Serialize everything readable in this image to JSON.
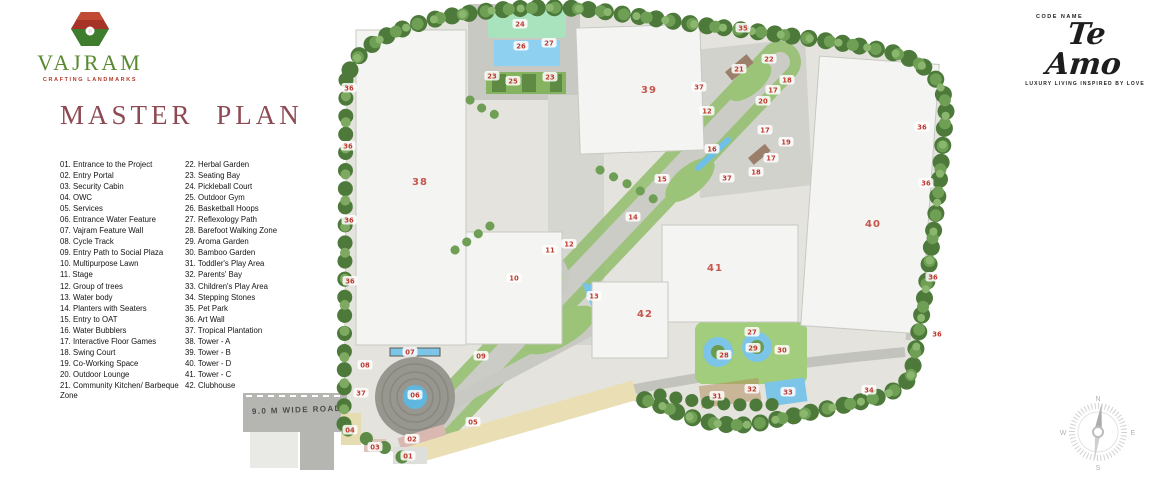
{
  "brand": {
    "name": "VAJRAM",
    "tagline": "CRAFTING LANDMARKS"
  },
  "project": {
    "pre": "CODE NAME",
    "name": "Te Amo",
    "tagline": "LUXURY LIVING INSPIRED BY LOVE"
  },
  "title": "MASTER PLAN",
  "legend": {
    "col1": [
      {
        "num": "01",
        "label": "Entrance to the Project"
      },
      {
        "num": "02",
        "label": "Entry Portal"
      },
      {
        "num": "03",
        "label": "Security Cabin"
      },
      {
        "num": "04",
        "label": "OWC"
      },
      {
        "num": "05",
        "label": "Services"
      },
      {
        "num": "06",
        "label": "Entrance Water Feature"
      },
      {
        "num": "07",
        "label": "Vajram Feature Wall"
      },
      {
        "num": "08",
        "label": "Cycle Track"
      },
      {
        "num": "09",
        "label": "Entry Path to Social Plaza"
      },
      {
        "num": "10",
        "label": "Multipurpose Lawn"
      },
      {
        "num": "11",
        "label": "Stage"
      },
      {
        "num": "12",
        "label": "Group of trees"
      },
      {
        "num": "13",
        "label": "Water body"
      },
      {
        "num": "14",
        "label": "Planters with Seaters"
      },
      {
        "num": "15",
        "label": "Entry to OAT"
      },
      {
        "num": "16",
        "label": "Water Bubblers"
      },
      {
        "num": "17",
        "label": "Interactive Floor Games"
      },
      {
        "num": "18",
        "label": "Swing Court"
      },
      {
        "num": "19",
        "label": "Co-Working Space"
      },
      {
        "num": "20",
        "label": "Outdoor Lounge"
      },
      {
        "num": "21",
        "label": "Community Kitchen/ Barbeque Zone"
      }
    ],
    "col2": [
      {
        "num": "22",
        "label": "Herbal Garden"
      },
      {
        "num": "23",
        "label": "Seating Bay"
      },
      {
        "num": "24",
        "label": "Pickleball Court"
      },
      {
        "num": "25",
        "label": "Outdoor Gym"
      },
      {
        "num": "26",
        "label": "Basketball Hoops"
      },
      {
        "num": "27",
        "label": "Reflexology Path"
      },
      {
        "num": "28",
        "label": "Barefoot Walking Zone"
      },
      {
        "num": "29",
        "label": "Aroma Garden"
      },
      {
        "num": "30",
        "label": "Bamboo Garden"
      },
      {
        "num": "31",
        "label": "Toddler's Play Area"
      },
      {
        "num": "32",
        "label": "Parents' Bay"
      },
      {
        "num": "33",
        "label": "Children's Play Area"
      },
      {
        "num": "34",
        "label": "Stepping Stones"
      },
      {
        "num": "35",
        "label": "Pet Park"
      },
      {
        "num": "36",
        "label": "Art Wall"
      },
      {
        "num": "37",
        "label": "Tropical Plantation"
      },
      {
        "num": "38",
        "label": "Tower - A"
      },
      {
        "num": "39",
        "label": "Tower - B"
      },
      {
        "num": "40",
        "label": "Tower - D"
      },
      {
        "num": "41",
        "label": "Tower - C"
      },
      {
        "num": "42",
        "label": "Clubhouse"
      }
    ]
  },
  "plan": {
    "road_label": "9.0 M WIDE ROAD",
    "compass": {
      "n": "N",
      "e": "E",
      "s": "S",
      "w": "W"
    },
    "markers": [
      [
        "01",
        408,
        456
      ],
      [
        "02",
        412,
        439
      ],
      [
        "03",
        375,
        447
      ],
      [
        "04",
        350,
        430
      ],
      [
        "05",
        473,
        422
      ],
      [
        "06",
        415,
        395
      ],
      [
        "07",
        410,
        352
      ],
      [
        "08",
        365,
        365
      ],
      [
        "09",
        481,
        356
      ],
      [
        "10",
        514,
        278
      ],
      [
        "11",
        550,
        250
      ],
      [
        "12",
        569,
        244
      ],
      [
        "12",
        707,
        111
      ],
      [
        "13",
        594,
        296
      ],
      [
        "14",
        633,
        217
      ],
      [
        "15",
        662,
        179
      ],
      [
        "16",
        712,
        149
      ],
      [
        "17",
        773,
        90
      ],
      [
        "17",
        765,
        130
      ],
      [
        "17",
        771,
        158
      ],
      [
        "18",
        787,
        80
      ],
      [
        "18",
        756,
        172
      ],
      [
        "19",
        786,
        142
      ],
      [
        "20",
        763,
        101
      ],
      [
        "21",
        739,
        69
      ],
      [
        "22",
        769,
        59
      ],
      [
        "23",
        492,
        76
      ],
      [
        "23",
        550,
        77
      ],
      [
        "24",
        520,
        24
      ],
      [
        "25",
        513,
        81
      ],
      [
        "26",
        521,
        46
      ],
      [
        "27",
        549,
        43
      ],
      [
        "27",
        752,
        332
      ],
      [
        "28",
        724,
        355
      ],
      [
        "29",
        753,
        348
      ],
      [
        "30",
        782,
        350
      ],
      [
        "31",
        717,
        396
      ],
      [
        "32",
        752,
        389
      ],
      [
        "33",
        788,
        392
      ],
      [
        "34",
        869,
        390
      ],
      [
        "35",
        743,
        28
      ],
      [
        "36",
        349,
        88
      ],
      [
        "36",
        348,
        146
      ],
      [
        "36",
        349,
        220
      ],
      [
        "36",
        350,
        281
      ],
      [
        "36",
        922,
        127
      ],
      [
        "36",
        926,
        183
      ],
      [
        "36",
        933,
        277
      ],
      [
        "36",
        937,
        334
      ],
      [
        "37",
        361,
        393
      ],
      [
        "37",
        699,
        87
      ],
      [
        "37",
        727,
        178
      ]
    ],
    "tower_labels": [
      [
        "38",
        420,
        185
      ],
      [
        "39",
        649,
        93
      ],
      [
        "40",
        873,
        227
      ],
      [
        "41",
        715,
        271
      ],
      [
        "42",
        645,
        317
      ]
    ]
  },
  "colors": {
    "title_maroon": "#8e4a52",
    "brand_green": "#57892e",
    "brand_red": "#b23a2a",
    "marker_red": "#c0392f",
    "tower_label_red": "#c4564d",
    "tree_dark": "#4d7a3a",
    "tree_mid": "#6f9f55",
    "tree_light": "#8ab66e",
    "lawn_green": "#a5d87e",
    "water_blue": "#7cc4e8",
    "building_white": "#f4f4f1",
    "road_gray": "#b7b7b3",
    "sand_beige": "#eadfb4"
  }
}
